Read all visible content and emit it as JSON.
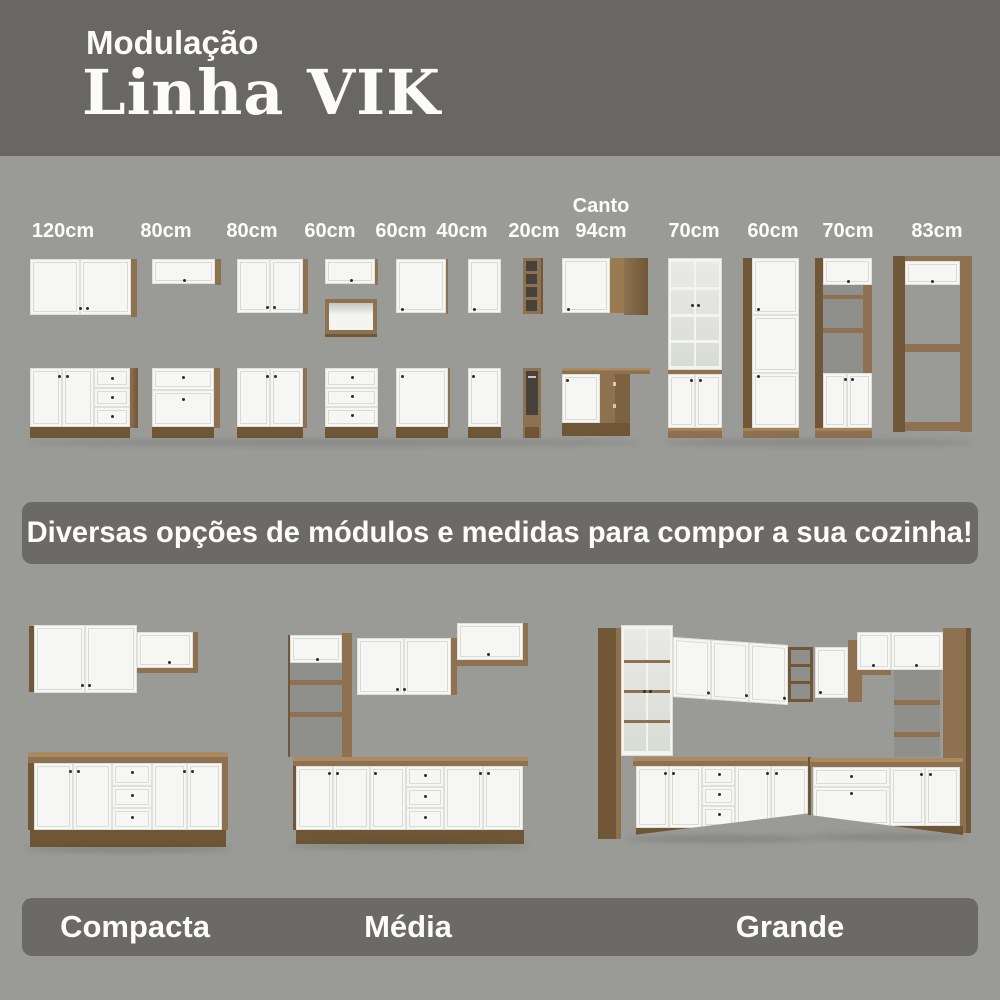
{
  "header": {
    "kicker": "Modulação",
    "title": "Linha VIK"
  },
  "modules": {
    "columns": [
      {
        "label": "120cm"
      },
      {
        "label": "80cm"
      },
      {
        "label": "80cm"
      },
      {
        "label": "60cm"
      },
      {
        "label": "60cm"
      },
      {
        "label": "40cm"
      },
      {
        "label": "20cm"
      },
      {
        "label_prefix": "Canto",
        "label": "94cm"
      },
      {
        "label": "70cm"
      },
      {
        "label": "60cm"
      },
      {
        "label": "70cm"
      },
      {
        "label": "83cm"
      }
    ]
  },
  "banner": {
    "text": "Diversas opções de módulos e medidas para compor a sua cozinha!"
  },
  "sizes": {
    "items": [
      {
        "label": "Compacta"
      },
      {
        "label": "Média"
      },
      {
        "label": "Grande"
      }
    ]
  },
  "colors": {
    "background": "#9a9a97",
    "band": "#686765",
    "banner": "#6b6a67",
    "wood": "#8d7150",
    "wood_dark": "#6f5738",
    "wood_light": "#a3825a",
    "cabinet_white": "#f6f6f4",
    "text": "#fcfcfa"
  }
}
